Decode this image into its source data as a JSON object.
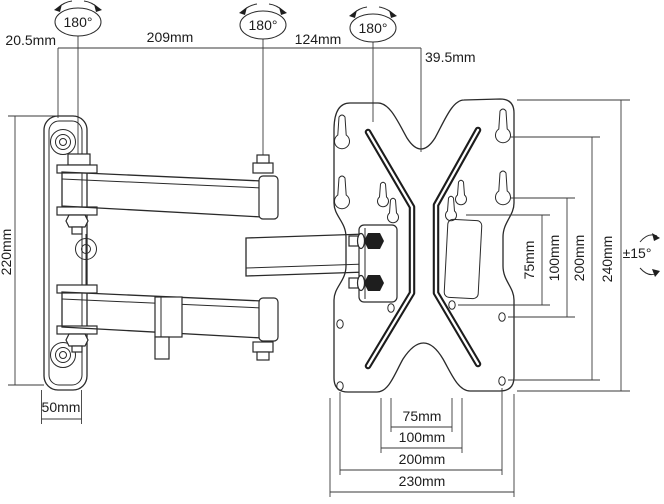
{
  "canvas": {
    "width": 664,
    "height": 504,
    "background": "#ffffff",
    "ink": "#2a2a2a"
  },
  "diagram_type": "tv-wall-mount-articulating-bracket-dimension-drawing",
  "labels": {
    "rot_hinge1": "180°",
    "rot_hinge2": "180°",
    "rot_hinge3": "180°",
    "tilt_range": "±15°",
    "top_offset_wall": "20.5mm",
    "top_arm1_length": "209mm",
    "top_arm2_length": "124mm",
    "top_plate_offset": "39.5mm",
    "left_wallplate_height": "220mm",
    "left_wallplate_width": "50mm",
    "right_vesa_75": "75mm",
    "right_vesa_100": "100mm",
    "right_vesa_200": "200mm",
    "right_plate_height": "240mm",
    "bottom_vesa_75": "75mm",
    "bottom_vesa_100": "100mm",
    "bottom_vesa_200": "200mm",
    "bottom_plate_width": "230mm"
  }
}
